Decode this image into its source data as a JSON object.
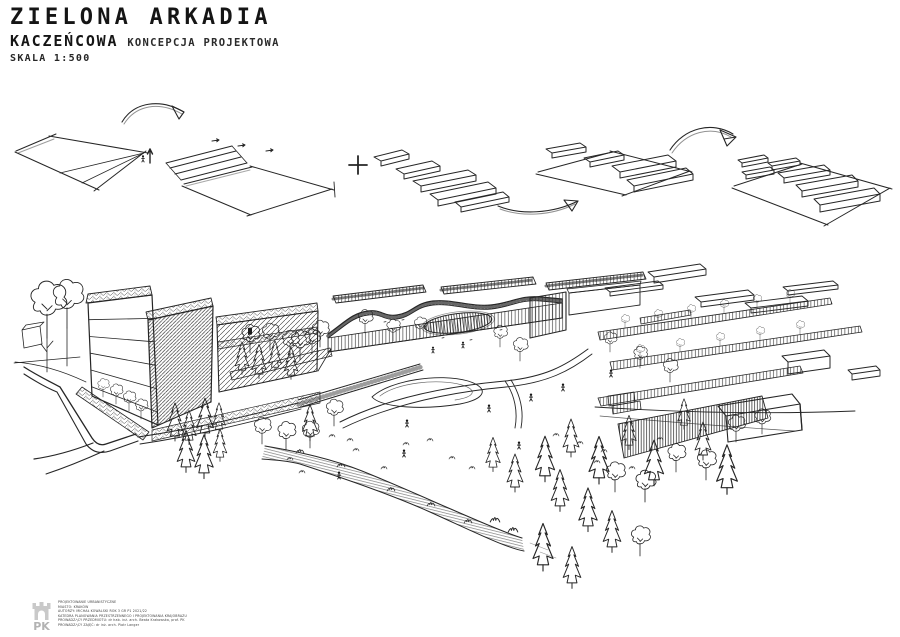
{
  "header": {
    "title": "ZIELONA ARKADIA",
    "project": "KACZEŃCOWA",
    "subtitle": "KONCEPCJA PROJEKTOWA",
    "scale": "SKALA 1:500"
  },
  "footer": {
    "logo": "PK",
    "credit_lines": [
      "PROJEKTOWANIE URBANISTYCZNE",
      "MIASTO: KRAKÓW",
      "AUTORZY: MICHAŁ KOWALSKI  ROK 3  GR P1  2021/22",
      "KATEDRA PLANOWANIA PRZESTRZENNEGO I PROJEKTOWANIA KRAJOBRAZU",
      "PROWADZĄCY PRZEDMIOTU: dr hab. inż. arch. Beata Krakowska, prof. PK",
      "PROWADZĄCY ZAJĘĆ: dr inż. arch. Piotr Langer"
    ]
  },
  "colors": {
    "ink": "#262626",
    "paper": "#ffffff",
    "logo_gray": "#c9c9c9"
  }
}
